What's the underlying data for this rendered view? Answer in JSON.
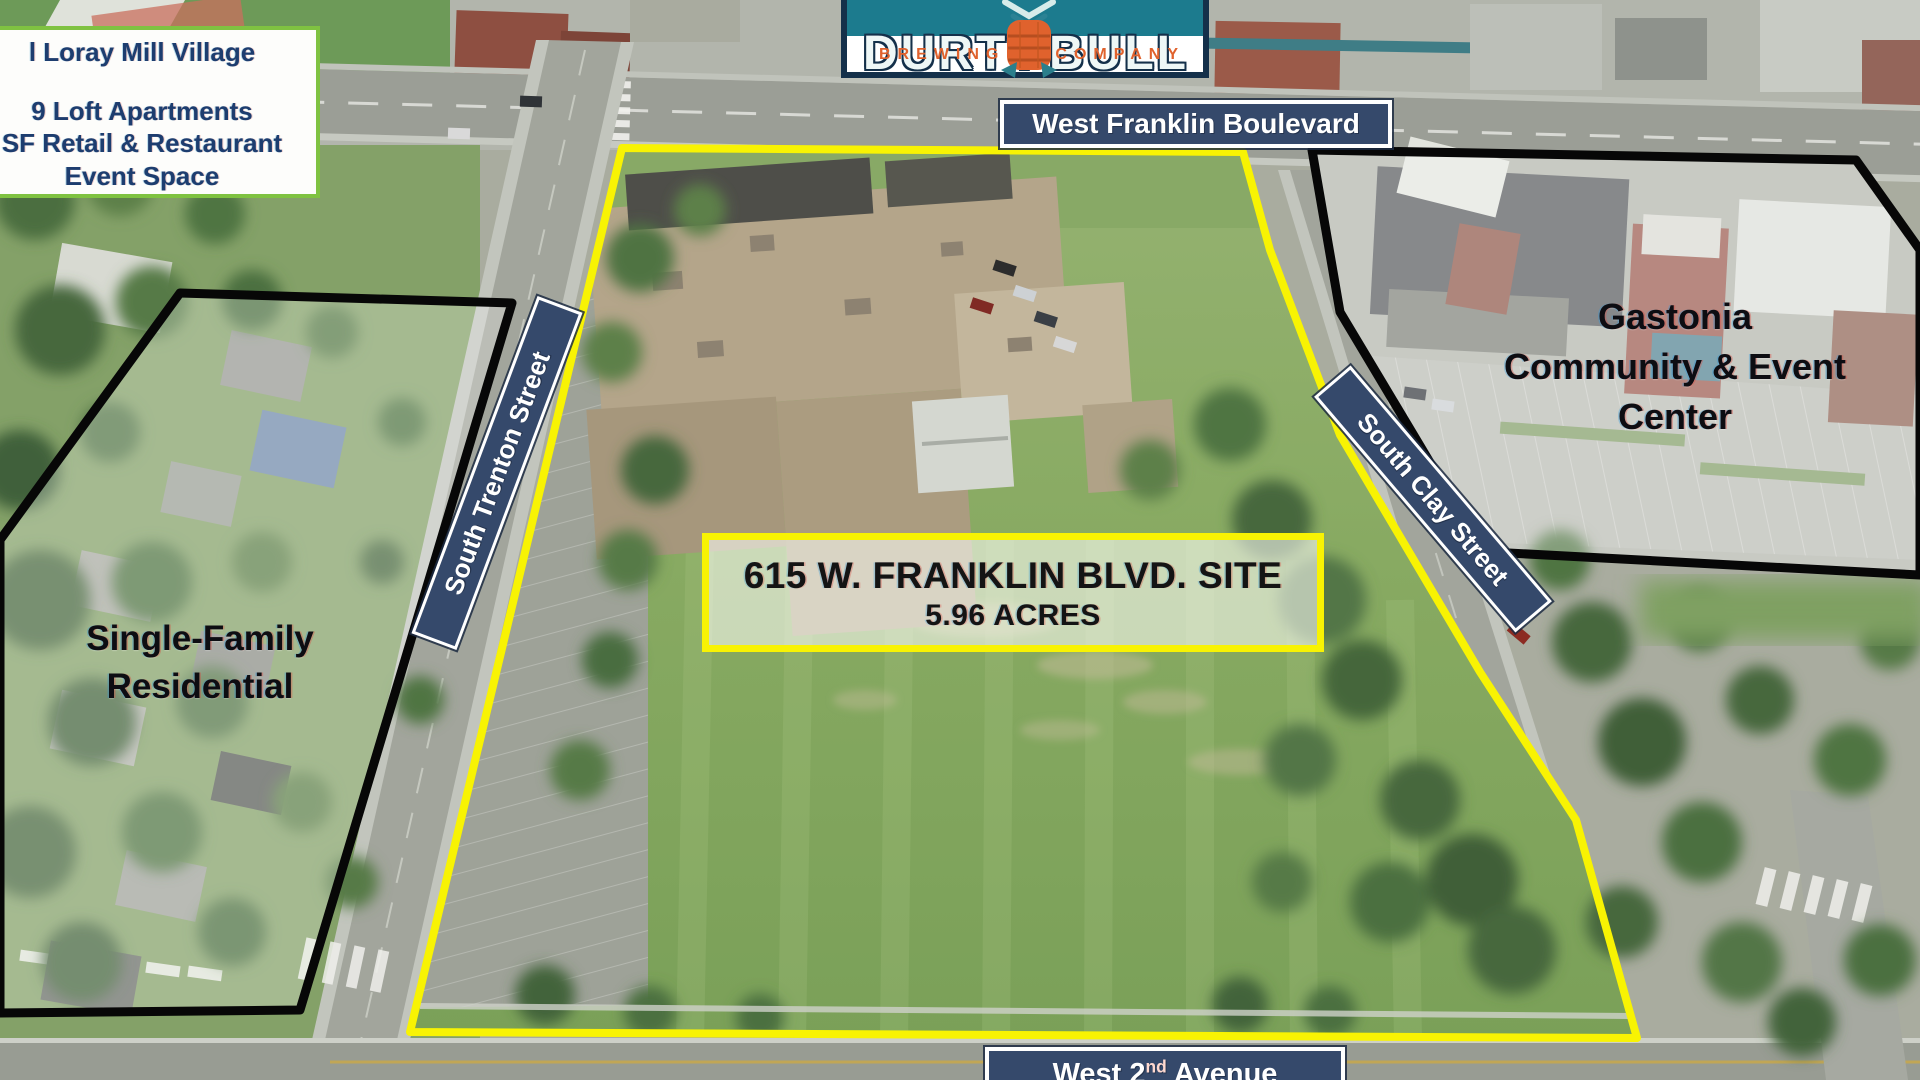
{
  "site": {
    "title": "615 W. FRANKLIN BLVD. SITE",
    "acreage": "5.96 ACRES"
  },
  "streets": {
    "west_franklin": "West Franklin Boulevard",
    "south_trenton": "South Trenton Street",
    "south_clay": "South Clay Street",
    "west_second_prefix": "West 2",
    "west_second_sup": "nd",
    "west_second_suffix": "Avenue"
  },
  "areas": {
    "gastonia": [
      "Gastonia",
      "Community & Event",
      "Center"
    ],
    "single_family": [
      "Single-Family",
      "Residential"
    ]
  },
  "infobox": {
    "lines": [
      "l Loray Mill Village",
      "9 Loft Apartments",
      "SF Retail & Restaurant",
      "Event Space"
    ]
  },
  "logo": {
    "word1": "DURTY",
    "word2": "BULL",
    "sub1": "BREWING",
    "sub2": "COMPANY"
  },
  "colors": {
    "boundary_yellow": "#f8f303",
    "label_navy": "#35496b",
    "outline_black": "#070707",
    "logo_teal": "#1c7b8e",
    "logo_orange": "#e0622d",
    "logo_navy": "#14304a",
    "infobox_green": "#7fc241",
    "infobox_text": "#1d3d6f"
  }
}
